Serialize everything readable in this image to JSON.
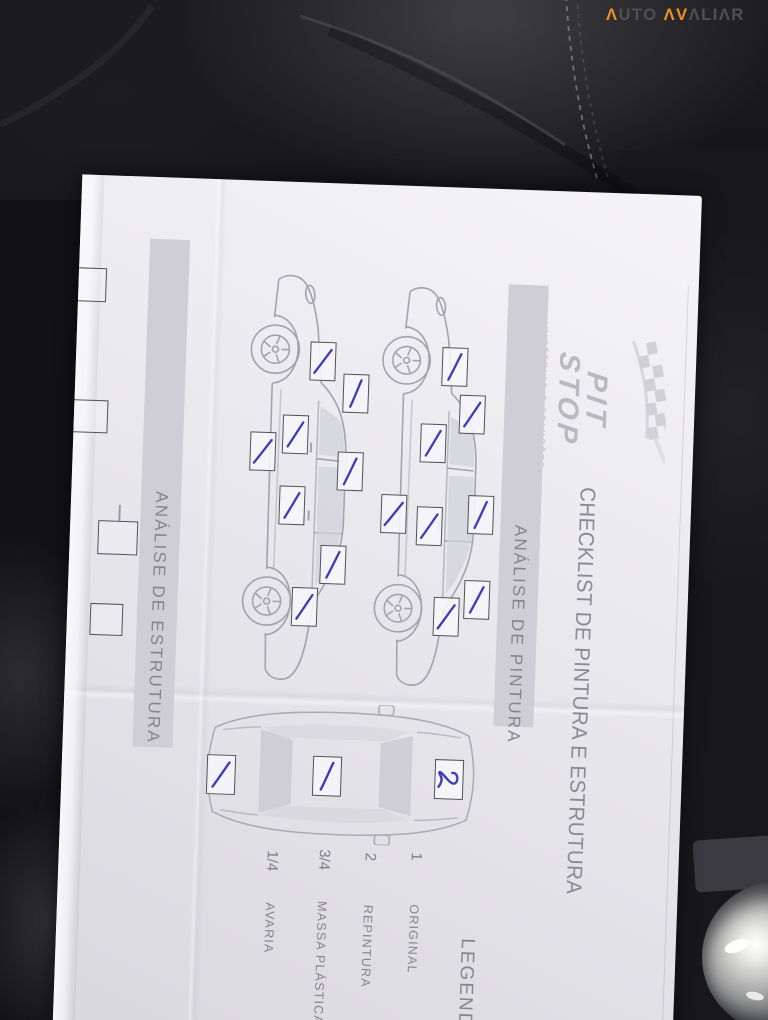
{
  "brand": {
    "a1": "Λ",
    "rest1": "UTO ",
    "a2": "ΛV",
    "rest2": "ΛLIΛR"
  },
  "paper": {
    "logo": {
      "line1": "PIT",
      "line2": "STOP",
      "tagline": "VISTORIAS E SOLUÇÕES"
    },
    "title": "CHECKLIST DE PINTURA E ESTRUTURA",
    "sections": {
      "paint": "ANÁLISE DE PINTURA",
      "structure": "ANÁLISE DE ESTRUTURA"
    },
    "legend": {
      "heading": "LEGENDA",
      "items": [
        {
          "code": "1",
          "label": "ORIGINAL"
        },
        {
          "code": "2",
          "label": "REPINTURA"
        },
        {
          "code": "3/4",
          "label": "MASSA PLÁSTICA/N"
        },
        {
          "code": "1/4",
          "label": "AVARIA"
        }
      ]
    },
    "marks": {
      "upper_car": [
        "1",
        "1",
        "1",
        "1",
        "1",
        "1",
        "1",
        "1"
      ],
      "lower_car": [
        "1",
        "1",
        "1",
        "1",
        "1",
        "1",
        "1",
        "1"
      ],
      "top_view": {
        "hood": "2",
        "roof": "1",
        "trunk": "1"
      }
    }
  }
}
